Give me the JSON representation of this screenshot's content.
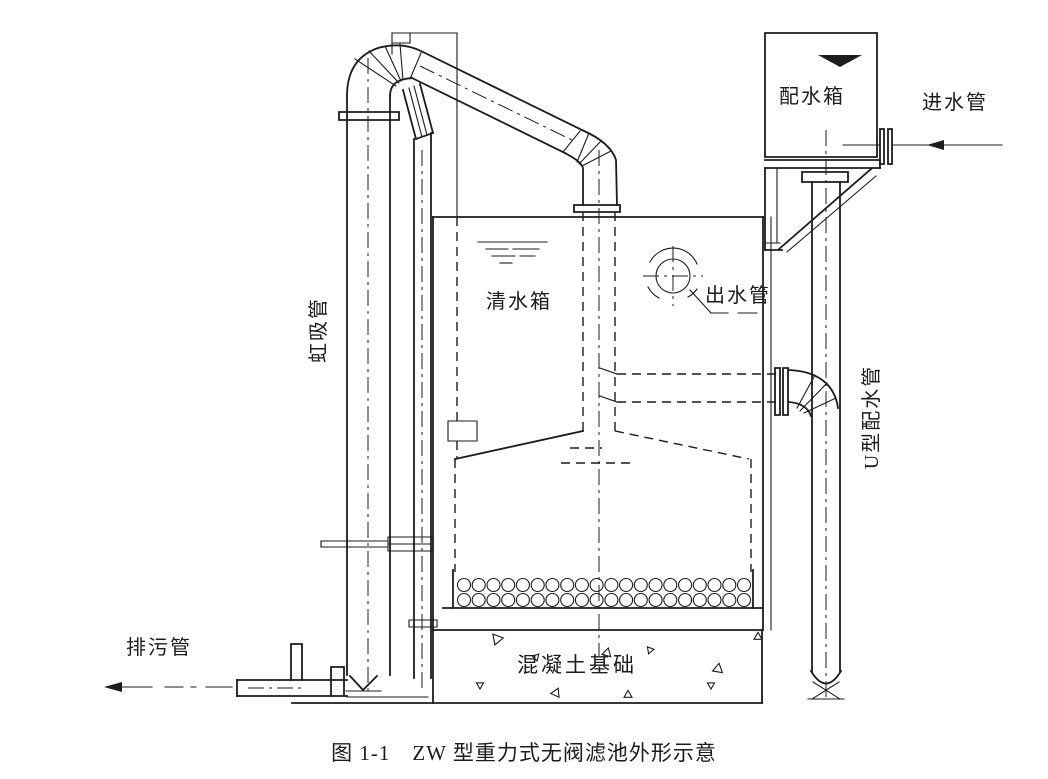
{
  "figure": {
    "type": "technical-diagram",
    "caption": "图 1-1　ZW 型重力式无阀滤池外形示意",
    "labels": {
      "distribution_box": "配水箱",
      "inlet_pipe": "进水管",
      "siphon_pipe": "虹吸管",
      "clear_water_tank": "清水箱",
      "outlet_pipe": "出水管",
      "u_type_distribution_pipe": "U型配水管",
      "drain_pipe": "排污管",
      "concrete_foundation": "混凝土基础"
    },
    "colors": {
      "line": "#1c1c1c",
      "paper": "#ffffff"
    },
    "filter_nozzles": {
      "rows": 2,
      "per_row": 20
    }
  }
}
